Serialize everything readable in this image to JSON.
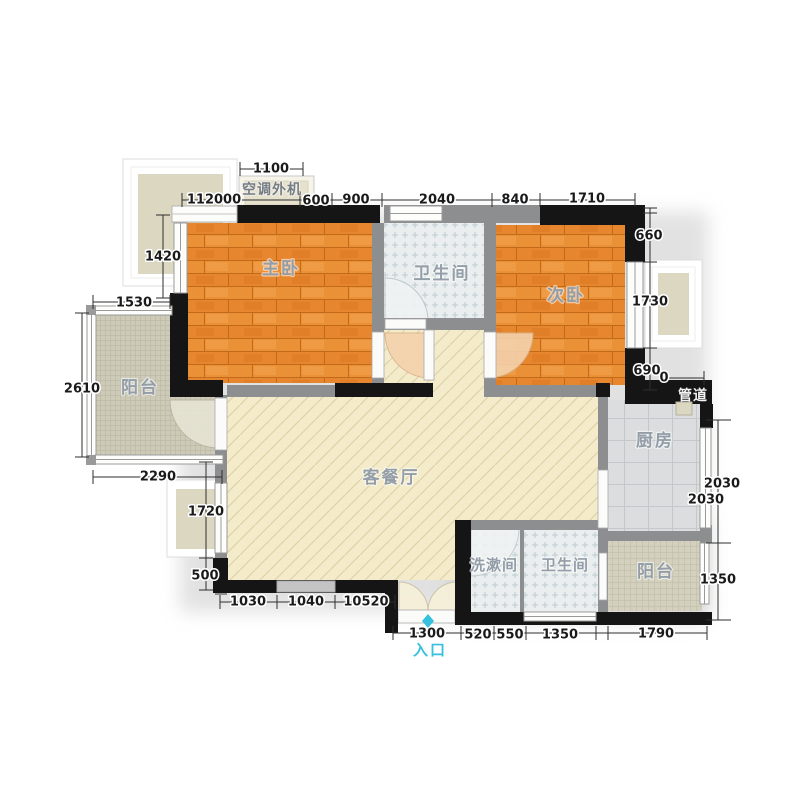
{
  "rooms": {
    "master_bedroom": "主卧",
    "second_bedroom": "次卧",
    "bathroom_top": "卫生间",
    "living_dining": "客餐厅",
    "kitchen": "厨房",
    "balcony_left": "阳台",
    "balcony_bottom_right": "阳台",
    "washroom": "洗漱间",
    "bathroom_bottom": "卫生间",
    "duct": "管道",
    "ac_outdoor_unit": "空调外机",
    "entrance": "入口"
  },
  "dimensions": {
    "top_ac": "1100",
    "top_row": [
      "112000",
      "600",
      "900",
      "2040",
      "840",
      "1710"
    ],
    "left_col": [
      "1420",
      "1530",
      "2610",
      "2290",
      "1720",
      "500"
    ],
    "right_col": [
      "660",
      "1730",
      "690",
      "0",
      "2030",
      "2030",
      "1350"
    ],
    "bottom_inner": [
      "1030",
      "1040",
      "10520"
    ],
    "bottom_outer": [
      "1300",
      "520",
      "550",
      "1350",
      "1790"
    ]
  },
  "colors": {
    "wood_floor": "#e6862e",
    "living_floor": "#f3ebca",
    "bath_tile": "#eaeeee",
    "kitchen_tile": "#dcddde",
    "balcony_mosaic": "#cdcab8",
    "wall_black": "#151515",
    "wall_gray": "#8d8e90",
    "bay_inner": "#dcd7c1",
    "dim_text": "#1a1a1a",
    "room_label": "#939ea8",
    "entrance_accent": "#35c0de"
  }
}
